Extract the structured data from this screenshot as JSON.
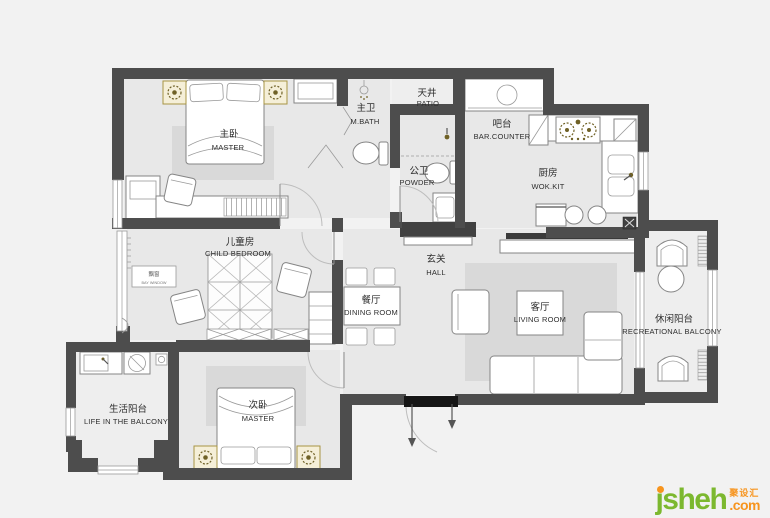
{
  "plan": {
    "rooms": [
      {
        "id": "master-bedroom",
        "zh": "主卧",
        "en": "MASTER"
      },
      {
        "id": "master-bath",
        "zh": "主卫",
        "en": "M.BATH"
      },
      {
        "id": "patio",
        "zh": "天井",
        "en": "PATIO"
      },
      {
        "id": "bar-counter",
        "zh": "吧台",
        "en": "BAR.COUNTER"
      },
      {
        "id": "kitchen",
        "zh": "厨房",
        "en": "WOK.KIT"
      },
      {
        "id": "powder-room",
        "zh": "公卫",
        "en": "POWDER"
      },
      {
        "id": "child-bedroom",
        "zh": "儿童房",
        "en": "CHILD BEDROOM"
      },
      {
        "id": "hall",
        "zh": "玄关",
        "en": "HALL"
      },
      {
        "id": "dining-room",
        "zh": "餐厅",
        "en": "DINING ROOM"
      },
      {
        "id": "living-room",
        "zh": "客厅",
        "en": "LIVING ROOM"
      },
      {
        "id": "recreational-balcony",
        "zh": "休闲阳台",
        "en": "RECREATIONAL BALCONY"
      },
      {
        "id": "life-balcony",
        "zh": "生活阳台",
        "en": "LIFE IN THE BALCONY"
      },
      {
        "id": "second-bedroom",
        "zh": "次卧",
        "en": "MASTER"
      },
      {
        "id": "bay-window",
        "zh": "飘窗",
        "en": "BAY WINDOW"
      }
    ]
  },
  "watermark": {
    "name": "jsheh",
    "zh": "聚设汇",
    "tld": ".com"
  },
  "colors": {
    "background": "#f2f2f2",
    "wall": "#4d4d4d",
    "floor": "#e8e8e8",
    "floor_light": "#eeeeee",
    "rug": "#d9d9d9",
    "threshold": "#161616",
    "nightstand_fill": "#f5efd8",
    "nightstand_stroke": "#a89544",
    "label_text": "#2e2e2e",
    "tv": "#3a3a3a",
    "cabinet_dark": "#414141",
    "logo_green": "#7cb82f",
    "logo_orange": "#f7941d"
  }
}
